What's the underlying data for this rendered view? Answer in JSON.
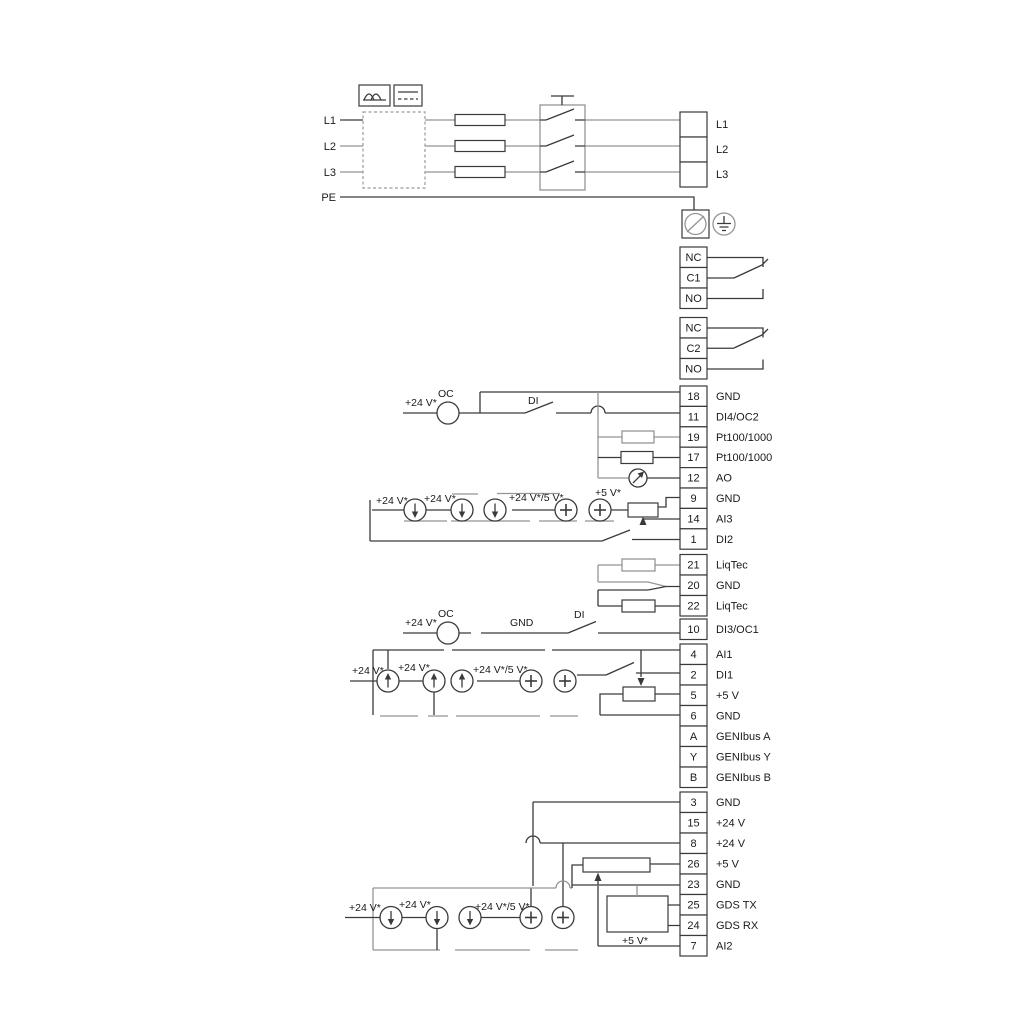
{
  "power": {
    "inputs": [
      "L1",
      "L2",
      "L3",
      "PE"
    ],
    "outputs": [
      "L1",
      "L2",
      "L3"
    ]
  },
  "relay1": {
    "t0": "NC",
    "t1": "C1",
    "t2": "NO"
  },
  "relay2": {
    "t0": "NC",
    "t1": "C2",
    "t2": "NO"
  },
  "terminals": {
    "io_top": [
      {
        "n": "18",
        "t": "GND"
      },
      {
        "n": "11",
        "t": "DI4/OC2"
      },
      {
        "n": "19",
        "t": "Pt100/1000"
      },
      {
        "n": "17",
        "t": "Pt100/1000"
      },
      {
        "n": "12",
        "t": "AO"
      },
      {
        "n": "9",
        "t": "GND"
      },
      {
        "n": "14",
        "t": "AI3"
      },
      {
        "n": "1",
        "t": "DI2"
      }
    ],
    "liqtec": [
      {
        "n": "21",
        "t": "LiqTec"
      },
      {
        "n": "20",
        "t": "GND"
      },
      {
        "n": "22",
        "t": "LiqTec"
      }
    ],
    "di3": [
      {
        "n": "10",
        "t": "DI3/OC1"
      }
    ],
    "io_mid": [
      {
        "n": "4",
        "t": "AI1"
      },
      {
        "n": "2",
        "t": "DI1"
      },
      {
        "n": "5",
        "t": "+5 V"
      },
      {
        "n": "6",
        "t": "GND"
      },
      {
        "n": "A",
        "t": "GENIbus A"
      },
      {
        "n": "Y",
        "t": "GENIbus Y"
      },
      {
        "n": "B",
        "t": "GENIbus B"
      }
    ],
    "io_bottom": [
      {
        "n": "3",
        "t": "GND"
      },
      {
        "n": "15",
        "t": "+24 V"
      },
      {
        "n": "8",
        "t": "+24 V"
      },
      {
        "n": "26",
        "t": "+5 V"
      },
      {
        "n": "23",
        "t": "GND"
      },
      {
        "n": "25",
        "t": "GDS TX"
      },
      {
        "n": "24",
        "t": "GDS RX"
      },
      {
        "n": "7",
        "t": "AI2"
      }
    ]
  },
  "labels": {
    "row_di4": {
      "v24": "+24 V*",
      "oc": "OC",
      "di": "DI"
    },
    "row_ai3": {
      "v24_a": "+24 V*",
      "v24_b": "+24 V*",
      "v24_5v": "+24 V*/5 V*",
      "v5": "+5 V*"
    },
    "row_di3": {
      "v24": "+24 V*",
      "oc": "OC",
      "gnd": "GND",
      "di": "DI"
    },
    "row_ai1": {
      "v24_a": "+24 V*",
      "v24_b": "+24 V*",
      "v24_5v": "+24 V*/5 V*"
    },
    "row_ai2": {
      "v24_a": "+24 V*",
      "v24_b": "+24 V*",
      "v24_5v": "+24 V*/5 V*"
    },
    "gds": {
      "v5": "+5 V*"
    }
  }
}
